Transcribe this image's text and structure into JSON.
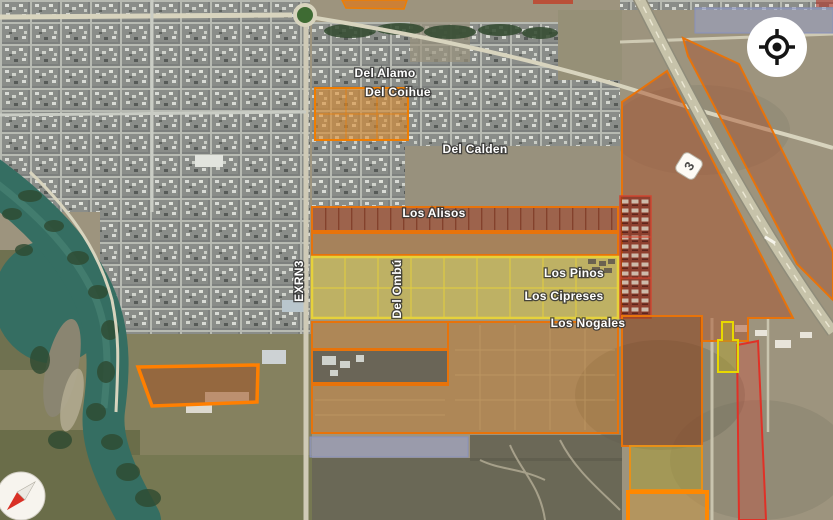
{
  "map_labels": {
    "del_alamo": "Del Alamo",
    "del_coihue": "Del Coihue",
    "del_calden": "Del Calden",
    "los_alisos": "Los Alisos",
    "los_pinos": "Los Pinos",
    "los_cipreses": "Los Cipreses",
    "los_nogales": "Los Nogales",
    "del_ombu": "Del Ombú",
    "exrn3": "EXRN3"
  },
  "route_shield": {
    "number": "3"
  },
  "controls": {
    "my_location_icon": "crosshair-target",
    "compass_icon": "compass-needle"
  },
  "colors": {
    "zone_orange_border": "#ef7b06",
    "zone_orange_border_bright": "#ff8800",
    "zone_tan_fill": "#c07a30",
    "zone_sienna_fill": "#a8502a",
    "zone_dark_brown_fill": "#8a4520",
    "zone_brick_fill": "#9c3b22",
    "zone_housing_fill": "#801f17",
    "zone_yellow_fill": "#d9c94e",
    "zone_yellow_border": "#e6d23b",
    "zone_olive_fill": "#a89a36",
    "zone_lavender_fill": "#98a0c9",
    "zone_red_border": "#e03127",
    "zone_red_fill": "#c94f3f",
    "water": "#356e62"
  }
}
